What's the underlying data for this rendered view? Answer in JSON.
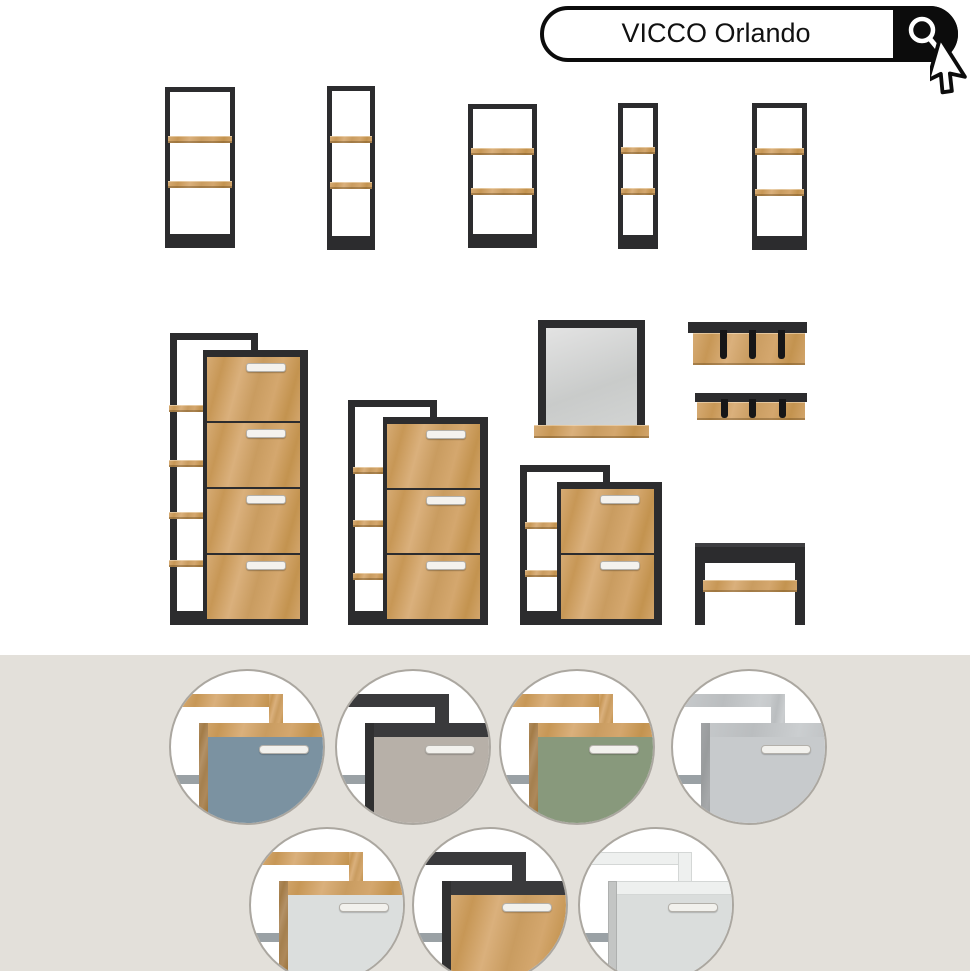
{
  "search": {
    "query": "VICCO Orlando",
    "button_icon": "magnifier-icon"
  },
  "cursor": "arrow-pointer",
  "palette": {
    "frame_black": "#2c2c2e",
    "oak": "#cda26b",
    "band_bg": "#e3e0da",
    "handle": "#f4f2ee",
    "mirror_glass": "#cfd1d0"
  },
  "products": {
    "wall_shelves": [
      {
        "id": "wall-shelf-1",
        "shelves": 2
      },
      {
        "id": "wall-shelf-2",
        "shelves": 2
      },
      {
        "id": "wall-shelf-3",
        "shelves": 2
      },
      {
        "id": "wall-shelf-4",
        "shelves": 2
      },
      {
        "id": "wall-shelf-5",
        "shelves": 2
      }
    ],
    "shoe_cabinets": [
      {
        "id": "shoe-cabinet-4-flaps",
        "drawers": 4,
        "side_shelves": 4
      },
      {
        "id": "shoe-cabinet-3-flaps",
        "drawers": 3,
        "side_shelves": 3
      },
      {
        "id": "shoe-cabinet-2-flaps",
        "drawers": 2,
        "side_shelves": 2
      }
    ],
    "mirror": {
      "id": "wall-mirror",
      "shelf": true
    },
    "coat_racks": [
      {
        "id": "coat-rack-large",
        "hooks": 3
      },
      {
        "id": "coat-rack-small",
        "hooks": 3
      }
    ],
    "bench": {
      "id": "shoe-bench",
      "shelf": true
    }
  },
  "variants": [
    {
      "id": "oak-blue",
      "frame": "oak",
      "front": "#7b92a1"
    },
    {
      "id": "anthracite-taupe",
      "frame": "anthracite",
      "front": "#b7b0a8"
    },
    {
      "id": "oak-green",
      "frame": "oak",
      "front": "#88997c"
    },
    {
      "id": "concrete-grey",
      "frame": "concrete",
      "front": "#c7cacc"
    },
    {
      "id": "oak-white",
      "frame": "oak",
      "front": "#dbdedd"
    },
    {
      "id": "anthracite-oak",
      "frame": "anthracite",
      "front": "oak"
    },
    {
      "id": "white-white",
      "frame": "white",
      "front": "#dadddc"
    }
  ]
}
